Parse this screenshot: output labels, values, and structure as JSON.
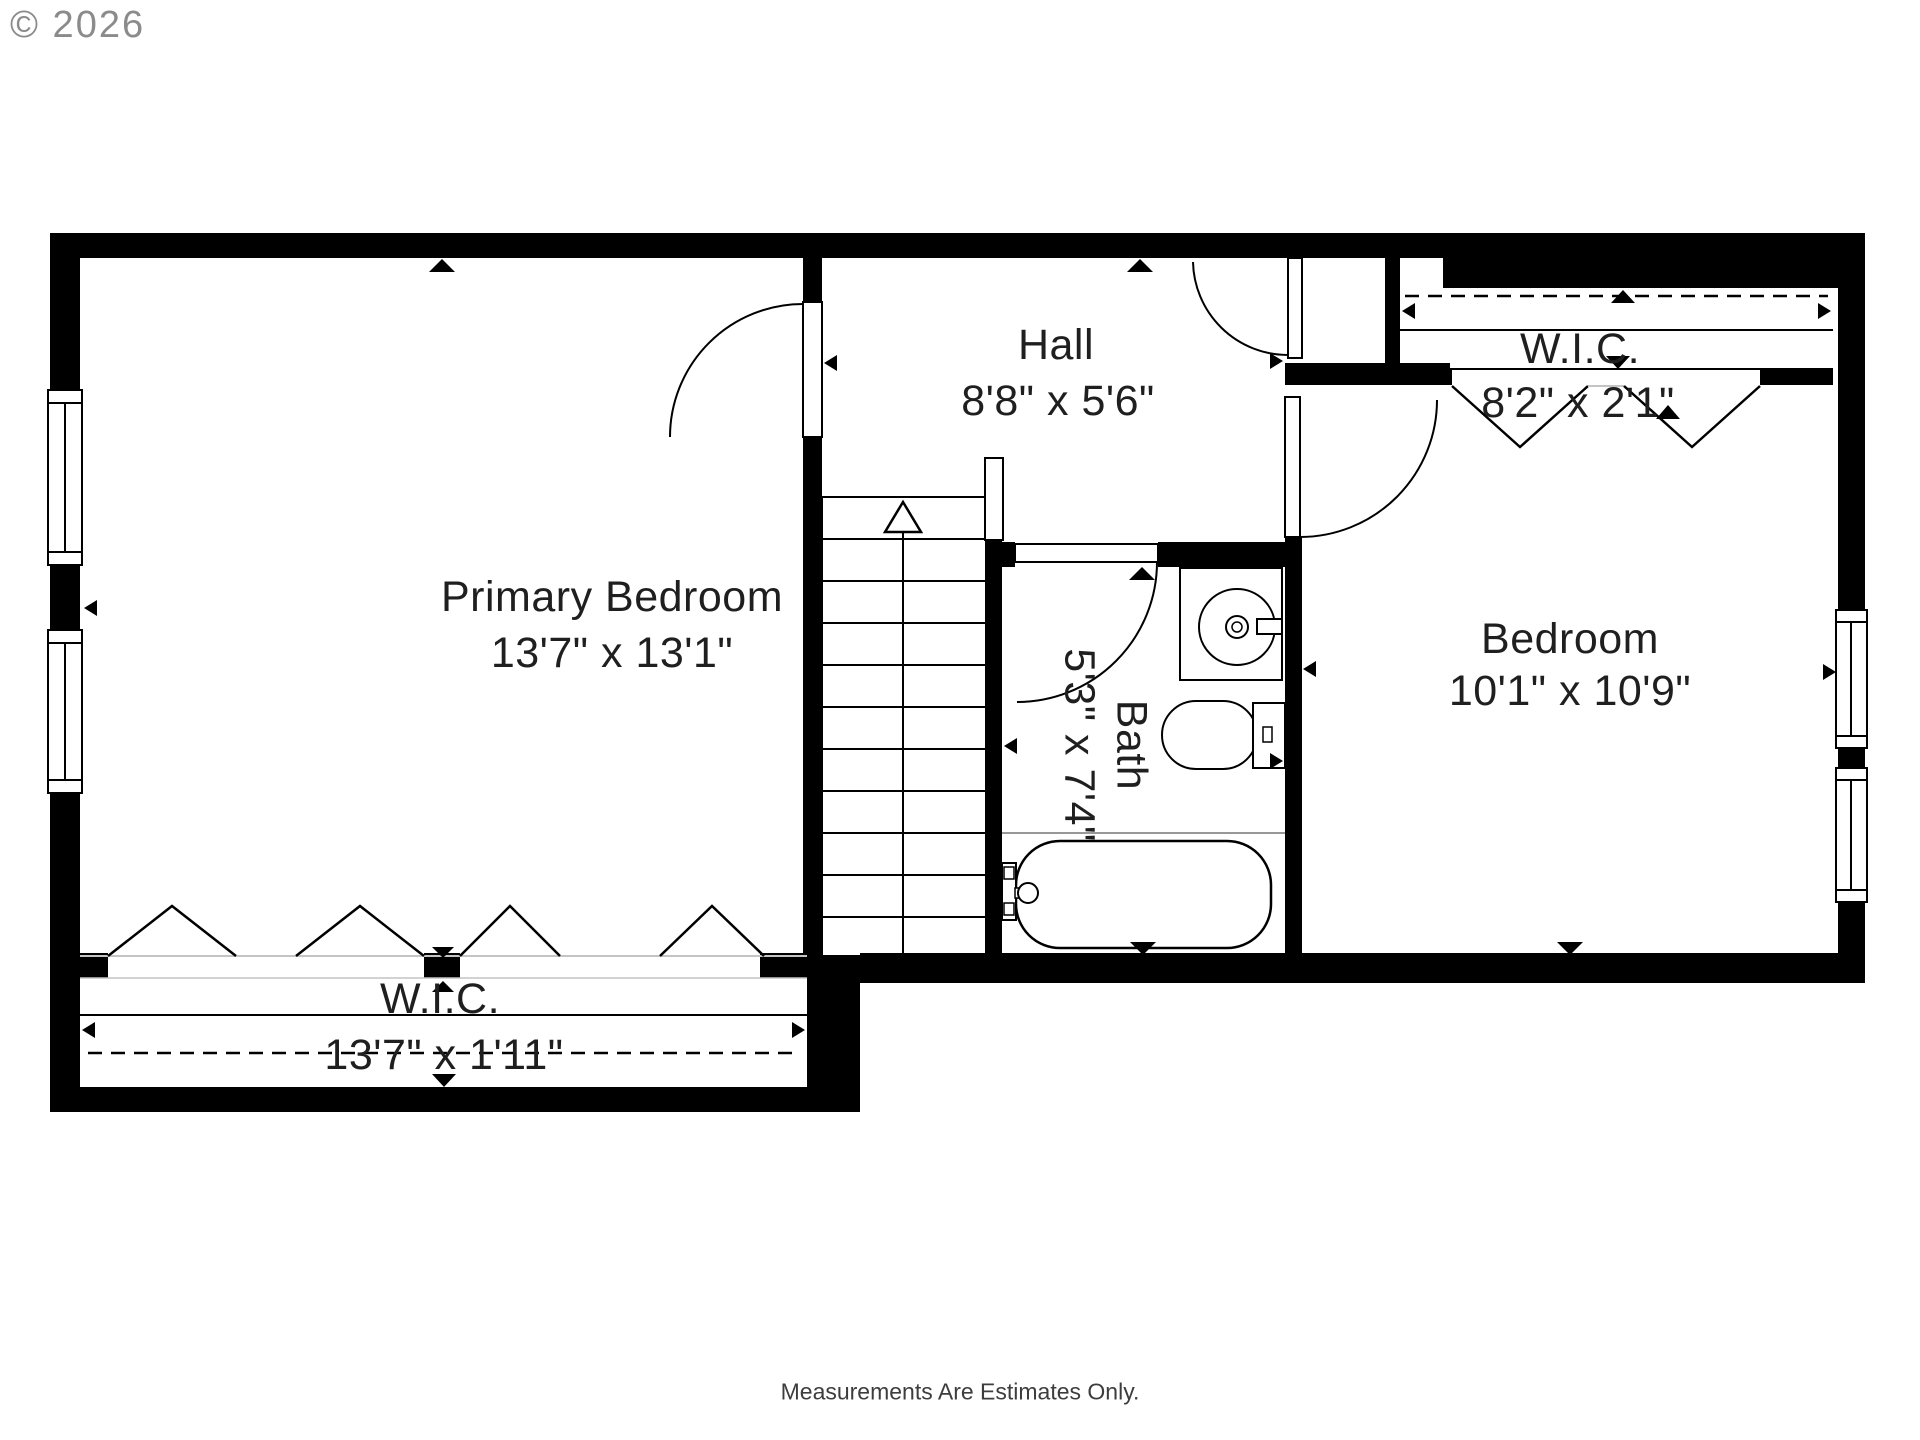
{
  "meta": {
    "copyright": "© 2026",
    "disclaimer": "Measurements Are Estimates Only."
  },
  "colors": {
    "wall": "#000000",
    "line": "#000000",
    "light": "#c4c4c4",
    "text": "#1f1f1f",
    "copy": "#8b8b8b",
    "bg": "#ffffff"
  },
  "rooms": {
    "primary_bedroom": {
      "name": "Primary Bedroom",
      "dimensions": "13'7\" x 13'1\""
    },
    "hall": {
      "name": "Hall",
      "dimensions": "8'8\" x 5'6\""
    },
    "wic_upper": {
      "name": "W.I.C.",
      "dimensions": "8'2\" x 2'1\""
    },
    "bedroom": {
      "name": "Bedroom",
      "dimensions": "10'1\" x 10'9\""
    },
    "bath": {
      "name": "Bath",
      "dimensions": "5'3\" x 7'4\""
    },
    "wic_lower": {
      "name": "W.I.C.",
      "dimensions": "13'7\" x 1'11\""
    }
  }
}
